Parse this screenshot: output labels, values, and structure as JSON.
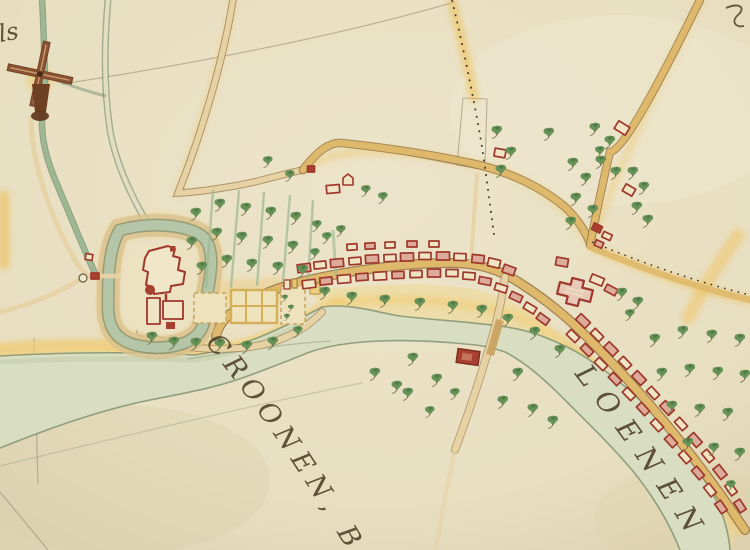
{
  "map": {
    "type": "historical-manuscript-map",
    "labels": {
      "river_name_left": "CROONEN, BURG",
      "river_name_right": "LOENEN",
      "corner_script_top_left": "ls"
    },
    "colors": {
      "paper": "#e8dfc1",
      "paper_light": "#efe7cf",
      "paper_shade": "#dcd1b0",
      "river": "#d9ddc1",
      "river_edge": "#768a67",
      "river_shade": "#c2cba8",
      "channel": "#9db895",
      "channel_edge": "#5c7a5e",
      "road": "#dfb96b",
      "road_pale": "#e6d2a4",
      "road_edge": "#92703f",
      "glow": "#f2b93e",
      "building_stroke": "#9e382c",
      "building_fill": "#efe4c4",
      "building_salmon": "#ddab9a",
      "building_solid": "#a8402f",
      "tree": "#679257",
      "tree_dark": "#3f6b3c",
      "tree_shadow": "#77764f",
      "ink": "#4c3d27",
      "pencil": "#8d8168",
      "windmill": "#8a5234",
      "windmill_dark": "#6f3f22",
      "moat": "#b5c5a8",
      "dot_ink": "#3a3127"
    },
    "features": {
      "trees": [
        [
          325,
          291,
          1
        ],
        [
          352,
          296,
          1
        ],
        [
          385,
          299,
          1
        ],
        [
          420,
          302,
          1
        ],
        [
          453,
          305,
          1
        ],
        [
          482,
          309,
          1
        ],
        [
          508,
          318,
          1
        ],
        [
          535,
          331,
          1
        ],
        [
          560,
          349,
          1
        ],
        [
          152,
          336,
          1
        ],
        [
          174,
          341,
          1
        ],
        [
          196,
          342,
          1
        ],
        [
          220,
          343,
          1
        ],
        [
          247,
          345,
          1
        ],
        [
          273,
          341,
          1
        ],
        [
          298,
          330,
          0.9
        ],
        [
          196,
          212,
          1
        ],
        [
          192,
          241,
          1
        ],
        [
          202,
          266,
          1
        ],
        [
          220,
          203,
          1
        ],
        [
          217,
          232,
          1
        ],
        [
          227,
          259,
          1
        ],
        [
          246,
          207,
          1
        ],
        [
          242,
          236,
          1
        ],
        [
          252,
          263,
          1
        ],
        [
          271,
          211,
          1
        ],
        [
          268,
          240,
          1
        ],
        [
          278,
          266,
          1
        ],
        [
          296,
          216,
          1
        ],
        [
          293,
          245,
          1
        ],
        [
          303,
          269,
          1
        ],
        [
          317,
          224,
          0.9
        ],
        [
          315,
          252,
          0.9
        ],
        [
          268,
          160,
          0.9
        ],
        [
          290,
          174,
          0.9
        ],
        [
          327,
          236,
          0.9
        ],
        [
          341,
          229,
          0.9
        ],
        [
          366,
          189,
          0.9
        ],
        [
          383,
          196,
          0.9
        ],
        [
          497,
          130,
          1
        ],
        [
          511,
          151,
          1
        ],
        [
          501,
          169,
          1
        ],
        [
          549,
          132,
          1
        ],
        [
          595,
          127,
          1
        ],
        [
          610,
          140,
          1
        ],
        [
          601,
          160,
          1
        ],
        [
          616,
          171,
          1
        ],
        [
          633,
          171,
          1
        ],
        [
          644,
          186,
          1
        ],
        [
          637,
          206,
          1
        ],
        [
          648,
          219,
          1
        ],
        [
          573,
          162,
          1
        ],
        [
          586,
          177,
          1
        ],
        [
          576,
          197,
          1
        ],
        [
          593,
          209,
          1
        ],
        [
          571,
          221,
          1
        ],
        [
          600,
          150,
          0.9
        ],
        [
          622,
          292,
          1
        ],
        [
          638,
          301,
          1
        ],
        [
          630,
          313,
          0.9
        ],
        [
          655,
          338,
          1
        ],
        [
          683,
          330,
          1
        ],
        [
          712,
          334,
          1
        ],
        [
          740,
          338,
          1
        ],
        [
          662,
          372,
          1
        ],
        [
          690,
          368,
          1
        ],
        [
          718,
          371,
          1
        ],
        [
          745,
          374,
          1
        ],
        [
          672,
          405,
          1
        ],
        [
          700,
          408,
          1
        ],
        [
          728,
          412,
          1
        ],
        [
          688,
          442,
          1
        ],
        [
          714,
          447,
          1
        ],
        [
          740,
          452,
          1
        ],
        [
          731,
          484,
          0.9
        ],
        [
          375,
          372,
          1
        ],
        [
          397,
          385,
          1
        ],
        [
          413,
          357,
          1
        ],
        [
          437,
          378,
          1
        ],
        [
          408,
          392,
          1
        ],
        [
          455,
          392,
          0.9
        ],
        [
          518,
          372,
          1
        ],
        [
          503,
          400,
          1
        ],
        [
          533,
          408,
          1
        ],
        [
          553,
          420,
          1
        ],
        [
          430,
          410,
          0.9
        ],
        [
          285,
          297,
          0.55
        ],
        [
          291,
          307,
          0.55
        ],
        [
          287,
          316,
          0.55
        ]
      ],
      "houses": [
        [
          304,
          268,
          13,
          8,
          -7,
          1
        ],
        [
          320,
          265,
          12,
          7,
          -6,
          0
        ],
        [
          337,
          263,
          13,
          8,
          -5,
          1
        ],
        [
          355,
          261,
          12,
          7,
          -4,
          0
        ],
        [
          372,
          259,
          13,
          8,
          -3,
          1
        ],
        [
          390,
          258,
          12,
          7,
          -2,
          0
        ],
        [
          407,
          257,
          13,
          8,
          -1,
          1
        ],
        [
          425,
          256,
          12,
          7,
          0,
          0
        ],
        [
          443,
          256,
          13,
          8,
          0,
          1
        ],
        [
          460,
          257,
          12,
          7,
          2,
          0
        ],
        [
          352,
          247,
          10,
          6,
          -4,
          0
        ],
        [
          370,
          246,
          10,
          6,
          -3,
          1
        ],
        [
          390,
          245,
          10,
          6,
          -2,
          0
        ],
        [
          412,
          244,
          10,
          6,
          0,
          1
        ],
        [
          434,
          244,
          10,
          6,
          0,
          0
        ],
        [
          309,
          284,
          13,
          8,
          -7,
          0
        ],
        [
          326,
          281,
          12,
          7,
          -6,
          1
        ],
        [
          344,
          279,
          13,
          8,
          -5,
          0
        ],
        [
          362,
          277,
          12,
          7,
          -4,
          1
        ],
        [
          380,
          276,
          13,
          8,
          -3,
          0
        ],
        [
          398,
          275,
          12,
          7,
          -2,
          1
        ],
        [
          416,
          274,
          12,
          7,
          -1,
          0
        ],
        [
          434,
          273,
          13,
          8,
          0,
          1
        ],
        [
          452,
          273,
          12,
          7,
          1,
          0
        ],
        [
          478,
          259,
          12,
          8,
          6,
          1
        ],
        [
          494,
          263,
          12,
          8,
          13,
          0
        ],
        [
          509,
          270,
          12,
          8,
          20,
          1
        ],
        [
          469,
          276,
          12,
          7,
          4,
          0
        ],
        [
          485,
          281,
          12,
          7,
          11,
          1
        ],
        [
          501,
          288,
          12,
          7,
          18,
          0
        ],
        [
          516,
          297,
          12,
          7,
          25,
          1
        ],
        [
          530,
          308,
          12,
          7,
          31,
          0
        ],
        [
          543,
          319,
          12,
          7,
          36,
          1
        ],
        [
          562,
          262,
          12,
          8,
          10,
          1
        ],
        [
          597,
          280,
          13,
          8,
          22,
          0
        ],
        [
          611,
          290,
          12,
          7,
          28,
          1
        ],
        [
          597,
          228,
          9,
          7,
          25,
          2
        ],
        [
          607,
          236,
          9,
          6,
          25,
          0
        ],
        [
          599,
          244,
          8,
          6,
          25,
          1
        ],
        [
          622,
          128,
          13,
          9,
          32,
          0
        ],
        [
          629,
          190,
          11,
          8,
          30,
          0
        ],
        [
          500,
          153,
          11,
          8,
          10,
          0
        ],
        [
          311,
          169,
          7,
          6,
          0,
          2
        ],
        [
          333,
          189,
          13,
          8,
          -5,
          0
        ],
        [
          95,
          276,
          8,
          6,
          0,
          2
        ],
        [
          89,
          257,
          7,
          6,
          10,
          0
        ],
        [
          583,
          321,
          13,
          8,
          44,
          1
        ],
        [
          597,
          335,
          12,
          7,
          45,
          0
        ],
        [
          611,
          349,
          13,
          8,
          45,
          1
        ],
        [
          625,
          363,
          12,
          7,
          46,
          0
        ],
        [
          639,
          378,
          13,
          8,
          46,
          1
        ],
        [
          653,
          393,
          12,
          7,
          47,
          0
        ],
        [
          667,
          408,
          13,
          8,
          47,
          1
        ],
        [
          681,
          424,
          12,
          7,
          48,
          0
        ],
        [
          695,
          440,
          13,
          8,
          48,
          1
        ],
        [
          708,
          456,
          12,
          7,
          50,
          0
        ],
        [
          720,
          472,
          13,
          8,
          52,
          1
        ],
        [
          731,
          489,
          12,
          7,
          55,
          0
        ],
        [
          740,
          506,
          12,
          7,
          57,
          1
        ],
        [
          573,
          336,
          12,
          7,
          44,
          0
        ],
        [
          587,
          350,
          12,
          7,
          45,
          1
        ],
        [
          601,
          364,
          12,
          7,
          45,
          0
        ],
        [
          615,
          379,
          12,
          7,
          46,
          1
        ],
        [
          629,
          394,
          12,
          7,
          46,
          0
        ],
        [
          643,
          409,
          12,
          7,
          47,
          1
        ],
        [
          657,
          425,
          12,
          7,
          47,
          0
        ],
        [
          671,
          441,
          12,
          7,
          48,
          1
        ],
        [
          685,
          457,
          12,
          7,
          49,
          0
        ],
        [
          698,
          473,
          12,
          7,
          50,
          1
        ],
        [
          710,
          490,
          12,
          7,
          52,
          0
        ],
        [
          721,
          507,
          12,
          7,
          55,
          1
        ]
      ]
    }
  }
}
